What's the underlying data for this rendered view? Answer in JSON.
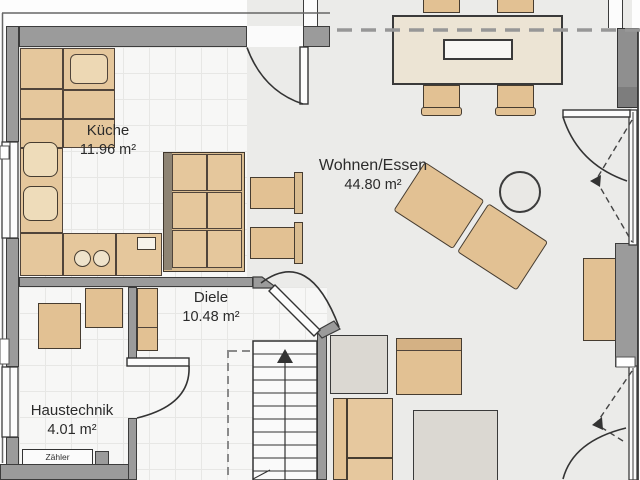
{
  "floorplan": {
    "rooms": [
      {
        "id": "kueche",
        "name": "Küche",
        "area": "11.96 m²"
      },
      {
        "id": "wohnen-essen",
        "name": "Wohnen/Essen",
        "area": "44.80 m²"
      },
      {
        "id": "diele",
        "name": "Diele",
        "area": "10.48 m²"
      },
      {
        "id": "haustechnik",
        "name": "Haustechnik",
        "area": "4.01 m²"
      }
    ],
    "meter_label": "Zähler",
    "stairs": {
      "direction_icon": "up-arrow"
    },
    "colors": {
      "wall": "#9b9b9b",
      "furniture_beige": "#e2c193",
      "dining_table": "#ece4d4",
      "living_floor": "#ebebe9",
      "tile_floor": "#f7f7f6"
    }
  }
}
